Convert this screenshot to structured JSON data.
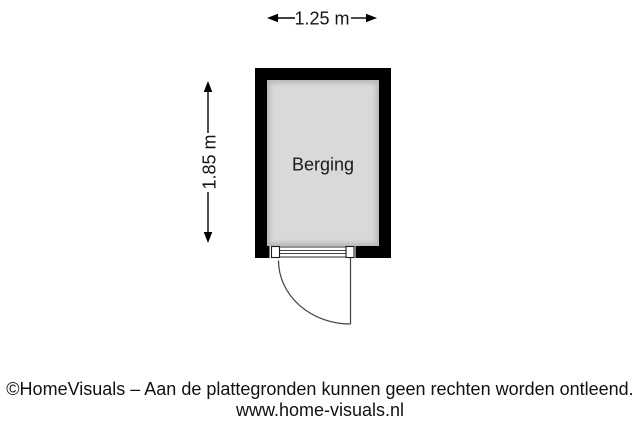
{
  "room": {
    "label": "Berging",
    "wall_color": "#000000",
    "floor_color": "#d8dad9"
  },
  "dimensions": {
    "width_label": "1.25 m",
    "height_label": "1.85 m"
  },
  "footer": {
    "disclaimer": "©HomeVisuals – Aan de plattegronden kunnen geen rechten worden ontleend.",
    "website": "www.home-visuals.nl"
  }
}
